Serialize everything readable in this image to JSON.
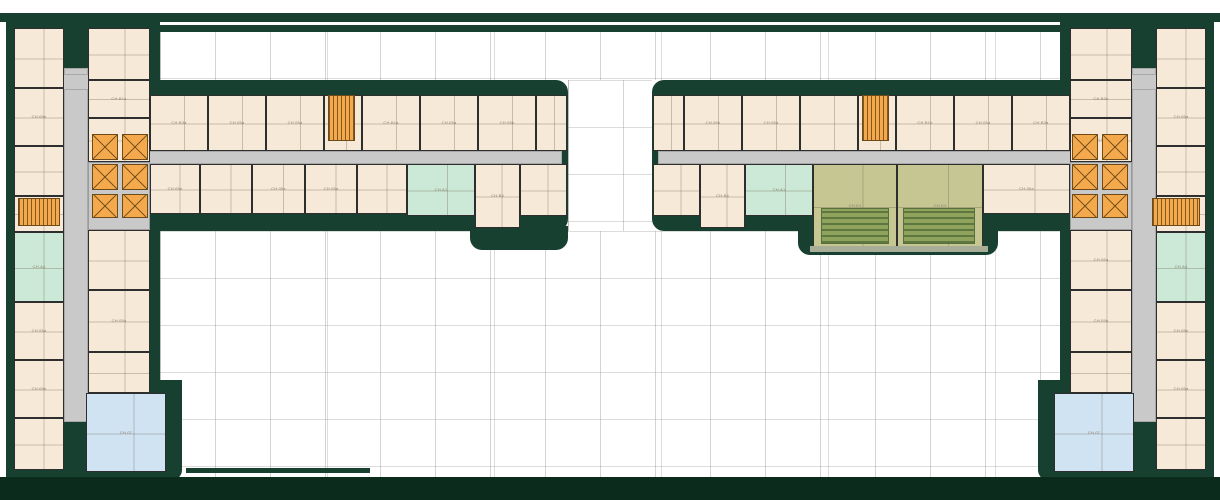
{
  "palette": {
    "wall_green": "#174030",
    "deep_green": "#0b2b1d",
    "unit_cream": "#f6e9d7",
    "unit_mint": "#cbe9d6",
    "unit_blue": "#cfe3f2",
    "unit_olive": "#c6c692",
    "core_orange": "#f5a94d",
    "corridor_gray": "#c9c9c9",
    "terrace_green": "#8fa35c",
    "grid_gray": "#8c8c8c",
    "label_gray": "#8a7e6c"
  },
  "plan": {
    "masses": [
      {
        "name": "top-canopy-band",
        "x": 0,
        "y": 13,
        "w": 1220,
        "h": 9
      },
      {
        "name": "top-court-edge-band",
        "x": 150,
        "y": 25,
        "w": 914,
        "h": 7
      },
      {
        "name": "left-wing-mass",
        "x": 6,
        "y": 13,
        "w": 154,
        "h": 467
      },
      {
        "name": "right-wing-mass",
        "x": 1060,
        "y": 13,
        "w": 154,
        "h": 467
      },
      {
        "name": "left-bar-mass",
        "x": 142,
        "y": 80,
        "w": 426,
        "h": 151,
        "r": "0 12px 12px 0"
      },
      {
        "name": "right-bar-mass",
        "x": 652,
        "y": 80,
        "w": 426,
        "h": 151,
        "r": "12px 0 0 12px"
      },
      {
        "name": "left-bar-step",
        "x": 470,
        "y": 226,
        "w": 98,
        "h": 24,
        "r": "0 0 12px 12px"
      },
      {
        "name": "right-bar-step",
        "x": 798,
        "y": 226,
        "w": 200,
        "h": 29,
        "r": "0 0 12px 12px"
      },
      {
        "name": "left-wing-bump",
        "x": 146,
        "y": 380,
        "w": 36,
        "h": 100,
        "r": "0 0 10px 0"
      },
      {
        "name": "right-wing-bump",
        "x": 1038,
        "y": 380,
        "w": 36,
        "h": 100,
        "r": "0 0 0 10px"
      },
      {
        "name": "bottom-edge-line",
        "x": 186,
        "y": 468,
        "w": 184,
        "h": 5
      },
      {
        "name": "bottom-band",
        "x": 0,
        "y": 477,
        "w": 1220,
        "h": 23,
        "deep": true
      }
    ],
    "courts": [
      {
        "name": "upper-court",
        "x": 160,
        "y": 31,
        "w": 900,
        "h": 49
      },
      {
        "name": "center-gap-court",
        "x": 568,
        "y": 80,
        "w": 84,
        "h": 151
      },
      {
        "name": "lower-court",
        "x": 160,
        "y": 231,
        "w": 900,
        "h": 246
      }
    ],
    "corridors": [
      {
        "name": "left-wing-corridor",
        "x": 64,
        "y": 68,
        "w": 24,
        "h": 354
      },
      {
        "name": "left-wing-top-corridor",
        "x": 14,
        "y": 74,
        "w": 76,
        "h": 16
      },
      {
        "name": "left-bar-corridor",
        "x": 88,
        "y": 151,
        "w": 474,
        "h": 13
      },
      {
        "name": "right-wing-corridor",
        "x": 1132,
        "y": 68,
        "w": 24,
        "h": 354
      },
      {
        "name": "right-wing-top-corridor",
        "x": 1130,
        "y": 74,
        "w": 76,
        "h": 16
      },
      {
        "name": "right-bar-corridor",
        "x": 658,
        "y": 151,
        "w": 474,
        "h": 13
      }
    ],
    "units": [
      {
        "x": 14,
        "y": 28,
        "w": 50,
        "h": 60,
        "type": "std"
      },
      {
        "x": 14,
        "y": 88,
        "w": 50,
        "h": 58,
        "type": "std",
        "label": "CH.05b"
      },
      {
        "x": 14,
        "y": 146,
        "w": 50,
        "h": 50,
        "type": "std"
      },
      {
        "x": 14,
        "y": 196,
        "w": 50,
        "h": 36,
        "type": "std"
      },
      {
        "x": 14,
        "y": 232,
        "w": 50,
        "h": 70,
        "type": "mint",
        "label": "CH.A4"
      },
      {
        "x": 14,
        "y": 302,
        "w": 50,
        "h": 58,
        "type": "std",
        "label": "CH.05a"
      },
      {
        "x": 14,
        "y": 360,
        "w": 50,
        "h": 58,
        "type": "std",
        "label": "CH.05b"
      },
      {
        "x": 14,
        "y": 418,
        "w": 50,
        "h": 52,
        "type": "std"
      },
      {
        "x": 88,
        "y": 28,
        "w": 62,
        "h": 52,
        "type": "std"
      },
      {
        "x": 88,
        "y": 80,
        "w": 62,
        "h": 38,
        "type": "std",
        "label": "CH.B1a"
      },
      {
        "x": 88,
        "y": 118,
        "w": 62,
        "h": 44,
        "type": "std"
      },
      {
        "x": 88,
        "y": 162,
        "w": 62,
        "h": 68,
        "type": "lobby"
      },
      {
        "x": 88,
        "y": 230,
        "w": 62,
        "h": 60,
        "type": "std"
      },
      {
        "x": 88,
        "y": 290,
        "w": 62,
        "h": 62,
        "type": "std",
        "label": "CH.05a"
      },
      {
        "x": 88,
        "y": 352,
        "w": 62,
        "h": 41,
        "type": "std"
      },
      {
        "x": 86,
        "y": 393,
        "w": 80,
        "h": 79,
        "type": "blue",
        "label": "CH.07"
      },
      {
        "x": 1156,
        "y": 28,
        "w": 50,
        "h": 60,
        "type": "std"
      },
      {
        "x": 1156,
        "y": 88,
        "w": 50,
        "h": 58,
        "type": "std",
        "label": "CH.05a"
      },
      {
        "x": 1156,
        "y": 146,
        "w": 50,
        "h": 50,
        "type": "std"
      },
      {
        "x": 1156,
        "y": 196,
        "w": 50,
        "h": 36,
        "type": "std"
      },
      {
        "x": 1156,
        "y": 232,
        "w": 50,
        "h": 70,
        "type": "mint",
        "label": "CH.A4"
      },
      {
        "x": 1156,
        "y": 302,
        "w": 50,
        "h": 58,
        "type": "std",
        "label": "CH.05e"
      },
      {
        "x": 1156,
        "y": 360,
        "w": 50,
        "h": 58,
        "type": "std",
        "label": "CH.05a"
      },
      {
        "x": 1156,
        "y": 418,
        "w": 50,
        "h": 52,
        "type": "std"
      },
      {
        "x": 1070,
        "y": 28,
        "w": 62,
        "h": 52,
        "type": "std"
      },
      {
        "x": 1070,
        "y": 80,
        "w": 62,
        "h": 38,
        "type": "std",
        "label": "CH.B2b"
      },
      {
        "x": 1070,
        "y": 118,
        "w": 62,
        "h": 44,
        "type": "std",
        "label": "CH.05a"
      },
      {
        "x": 1070,
        "y": 162,
        "w": 62,
        "h": 68,
        "type": "lobby"
      },
      {
        "x": 1070,
        "y": 230,
        "w": 62,
        "h": 60,
        "type": "std",
        "label": "CH.05a"
      },
      {
        "x": 1070,
        "y": 290,
        "w": 62,
        "h": 62,
        "type": "std",
        "label": "CH.05b"
      },
      {
        "x": 1070,
        "y": 352,
        "w": 62,
        "h": 41,
        "type": "std"
      },
      {
        "x": 1054,
        "y": 393,
        "w": 80,
        "h": 79,
        "type": "blue",
        "label": "CH.07"
      },
      {
        "x": 150,
        "y": 95,
        "w": 58,
        "h": 56,
        "type": "std",
        "label": "CH.B3a"
      },
      {
        "x": 208,
        "y": 95,
        "w": 58,
        "h": 56,
        "type": "std",
        "label": "CH.05a"
      },
      {
        "x": 266,
        "y": 95,
        "w": 58,
        "h": 56,
        "type": "std",
        "label": "CH.05a"
      },
      {
        "x": 324,
        "y": 95,
        "w": 38,
        "h": 56,
        "type": "std"
      },
      {
        "x": 362,
        "y": 95,
        "w": 58,
        "h": 56,
        "type": "std",
        "label": "CH.B1a"
      },
      {
        "x": 420,
        "y": 95,
        "w": 58,
        "h": 56,
        "type": "std",
        "label": "CH.05a"
      },
      {
        "x": 478,
        "y": 95,
        "w": 58,
        "h": 56,
        "type": "std",
        "label": "CH.05b"
      },
      {
        "x": 536,
        "y": 95,
        "w": 31,
        "h": 56,
        "type": "std"
      },
      {
        "x": 150,
        "y": 164,
        "w": 50,
        "h": 50,
        "type": "std",
        "label": "CH.05e"
      },
      {
        "x": 200,
        "y": 164,
        "w": 52,
        "h": 50,
        "type": "std"
      },
      {
        "x": 252,
        "y": 164,
        "w": 53,
        "h": 50,
        "type": "std",
        "label": "CH.05e"
      },
      {
        "x": 305,
        "y": 164,
        "w": 52,
        "h": 50,
        "type": "std",
        "label": "CH.05a"
      },
      {
        "x": 357,
        "y": 164,
        "w": 50,
        "h": 50,
        "type": "std"
      },
      {
        "x": 407,
        "y": 164,
        "w": 68,
        "h": 52,
        "type": "mint",
        "label": "CH.A1"
      },
      {
        "x": 475,
        "y": 164,
        "w": 45,
        "h": 64,
        "type": "std",
        "label": "CH.B4"
      },
      {
        "x": 520,
        "y": 164,
        "w": 47,
        "h": 52,
        "type": "std"
      },
      {
        "x": 653,
        "y": 95,
        "w": 31,
        "h": 56,
        "type": "std"
      },
      {
        "x": 684,
        "y": 95,
        "w": 58,
        "h": 56,
        "type": "std",
        "label": "CH.05b"
      },
      {
        "x": 742,
        "y": 95,
        "w": 58,
        "h": 56,
        "type": "std",
        "label": "CH.05a"
      },
      {
        "x": 800,
        "y": 95,
        "w": 58,
        "h": 56,
        "type": "std"
      },
      {
        "x": 858,
        "y": 95,
        "w": 38,
        "h": 56,
        "type": "std"
      },
      {
        "x": 896,
        "y": 95,
        "w": 58,
        "h": 56,
        "type": "std",
        "label": "CH.B1b"
      },
      {
        "x": 954,
        "y": 95,
        "w": 58,
        "h": 56,
        "type": "std",
        "label": "CH.05a"
      },
      {
        "x": 1012,
        "y": 95,
        "w": 58,
        "h": 56,
        "type": "std",
        "label": "CH.B3a"
      },
      {
        "x": 653,
        "y": 164,
        "w": 47,
        "h": 52,
        "type": "std"
      },
      {
        "x": 700,
        "y": 164,
        "w": 45,
        "h": 64,
        "type": "std",
        "label": "CH.B4"
      },
      {
        "x": 745,
        "y": 164,
        "w": 68,
        "h": 52,
        "type": "mint",
        "label": "CH.A1"
      },
      {
        "x": 813,
        "y": 164,
        "w": 84,
        "h": 84,
        "type": "olive",
        "label": "CH.E4"
      },
      {
        "x": 897,
        "y": 164,
        "w": 86,
        "h": 84,
        "type": "olive",
        "label": "CH.E4"
      },
      {
        "x": 983,
        "y": 164,
        "w": 87,
        "h": 50,
        "type": "std",
        "label": "CH.05a"
      }
    ],
    "cores": [
      {
        "kind": "lift",
        "x": 92,
        "y": 134,
        "w": 26,
        "h": 26
      },
      {
        "kind": "lift",
        "x": 122,
        "y": 134,
        "w": 26,
        "h": 26
      },
      {
        "kind": "lift",
        "x": 92,
        "y": 164,
        "w": 26,
        "h": 26
      },
      {
        "kind": "lift",
        "x": 122,
        "y": 164,
        "w": 26,
        "h": 26
      },
      {
        "kind": "lift",
        "x": 92,
        "y": 194,
        "w": 26,
        "h": 24
      },
      {
        "kind": "lift",
        "x": 122,
        "y": 194,
        "w": 26,
        "h": 24
      },
      {
        "kind": "lift",
        "x": 1072,
        "y": 134,
        "w": 26,
        "h": 26
      },
      {
        "kind": "lift",
        "x": 1102,
        "y": 134,
        "w": 26,
        "h": 26
      },
      {
        "kind": "lift",
        "x": 1072,
        "y": 164,
        "w": 26,
        "h": 26
      },
      {
        "kind": "lift",
        "x": 1102,
        "y": 164,
        "w": 26,
        "h": 26
      },
      {
        "kind": "lift",
        "x": 1072,
        "y": 194,
        "w": 26,
        "h": 24
      },
      {
        "kind": "lift",
        "x": 1102,
        "y": 194,
        "w": 26,
        "h": 24
      },
      {
        "kind": "stair",
        "x": 18,
        "y": 198,
        "w": 42,
        "h": 28
      },
      {
        "kind": "stair",
        "x": 1152,
        "y": 198,
        "w": 48,
        "h": 28
      },
      {
        "kind": "stair",
        "x": 328,
        "y": 95,
        "w": 27,
        "h": 46
      },
      {
        "kind": "stair",
        "x": 862,
        "y": 95,
        "w": 27,
        "h": 46
      }
    ],
    "terraces": [
      {
        "x": 821,
        "y": 208,
        "w": 68,
        "h": 36
      },
      {
        "x": 903,
        "y": 208,
        "w": 72,
        "h": 36
      },
      {
        "x": 810,
        "y": 246,
        "w": 178,
        "h": 6,
        "sill": true
      }
    ]
  }
}
